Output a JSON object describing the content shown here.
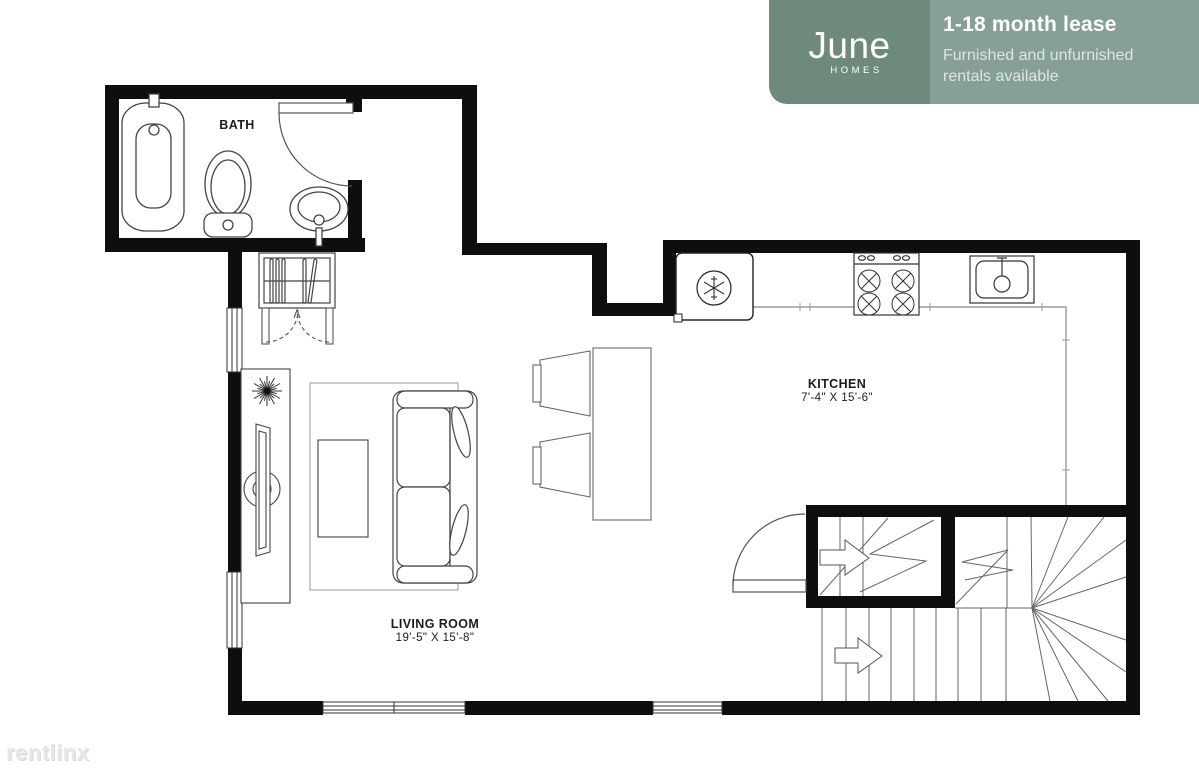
{
  "badge": {
    "brand": {
      "name": "June",
      "subtitle": "HOMES"
    },
    "title": "1-18 month lease",
    "description": "Furnished and unfurnished rentals available",
    "colors": {
      "brand_bg": "#6e8a7c",
      "info_bg": "#87a095",
      "text": "#ffffff"
    }
  },
  "floorplan": {
    "rooms": [
      {
        "id": "bath",
        "label": "BATH",
        "dims": ""
      },
      {
        "id": "kitchen",
        "label": "KITCHEN",
        "dims": "7'-4\" X 15'-6\""
      },
      {
        "id": "living_room",
        "label": "LIVING ROOM",
        "dims": "19'-5\" X 15'-8\""
      }
    ],
    "fixtures": [
      "bathtub",
      "toilet",
      "bathroom-sink",
      "bath-door",
      "wardrobe-closet",
      "closet-doors",
      "plant",
      "tv-console",
      "tv",
      "rug",
      "sofa",
      "coffee-table",
      "bar-counter",
      "bar-chairs",
      "refrigerator",
      "stove",
      "kitchen-sink",
      "kitchen-counter",
      "stair-door",
      "staircase",
      "windows",
      "walls"
    ],
    "line_colors": {
      "walls": "#0e0e0e",
      "furniture": "#444444",
      "stairs": "#666666"
    }
  },
  "watermark": {
    "text": "rentlinx"
  }
}
